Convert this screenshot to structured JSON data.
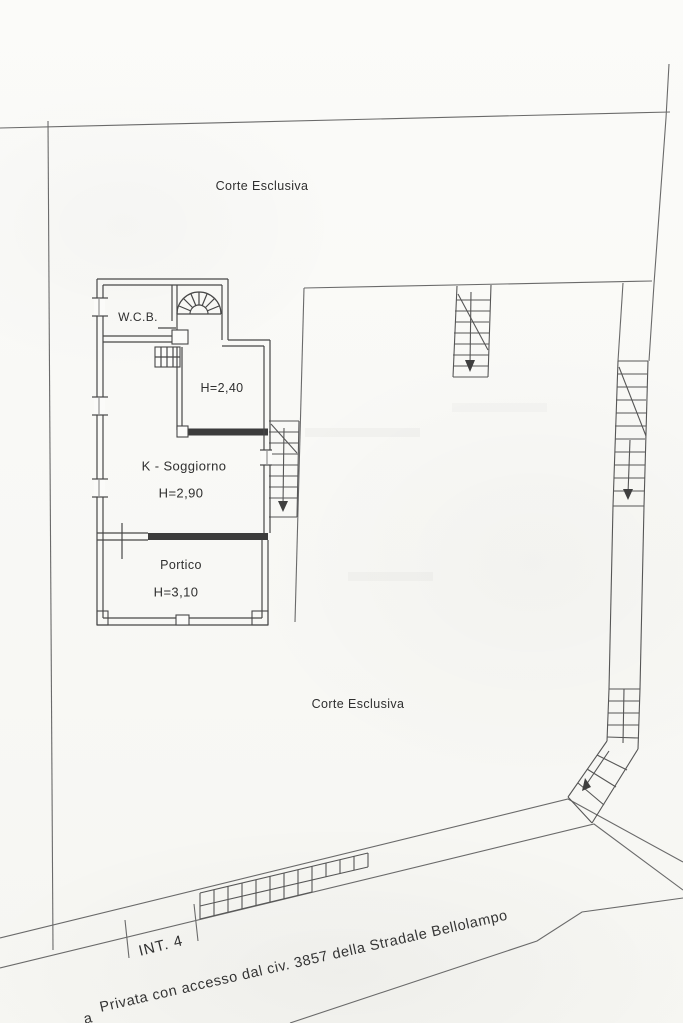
{
  "plan": {
    "court_top": "Corte Esclusiva",
    "court_bottom": "Corte Esclusiva",
    "rooms": [
      {
        "id": "wcb",
        "name": "W.C.B.",
        "height": ""
      },
      {
        "id": "room-h240",
        "name": "",
        "height": "H=2,40"
      },
      {
        "id": "soggiorno",
        "name": "K - Soggiorno",
        "height": "H=2,90"
      },
      {
        "id": "portico",
        "name": "Portico",
        "height": "H=3,10"
      }
    ],
    "unit_label": "INT. 4",
    "access_note_fragment": "a",
    "access_note": "Privata con accesso dal civ. 3857 della Stradale Bellolampo",
    "stairs": [
      {
        "id": "spiral-stair",
        "location": "building-top"
      },
      {
        "id": "building-side-stair",
        "direction": "down"
      },
      {
        "id": "courtyard-stair",
        "direction": "down"
      },
      {
        "id": "boundary-stair-upper",
        "direction": "down"
      },
      {
        "id": "boundary-stair-lower",
        "direction": "down-left"
      }
    ]
  },
  "colors": {
    "paper": "#fafaf7",
    "boundary_ink": "#6a6a6a",
    "wall_ink": "#474747",
    "thick_wall_ink": "#3c3c3c",
    "text_ink": "#2f2f2f"
  }
}
